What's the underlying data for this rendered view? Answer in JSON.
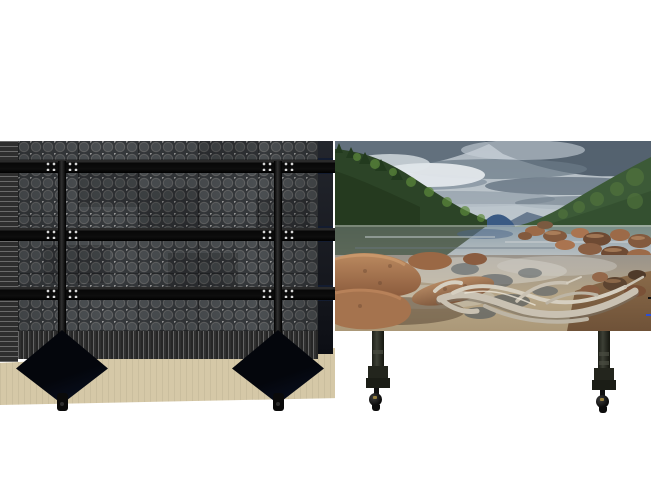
{
  "page": {
    "width": 670,
    "height": 497,
    "background": "#ffffff",
    "kind": "product-photo"
  },
  "product": {
    "name": "mobile-led-video-wall",
    "views": [
      {
        "id": "rear-view",
        "parts": [
          "perforated-back-panels",
          "frame-beam-top",
          "frame-beam-middle",
          "frame-beam-bottom",
          "stand-pole-left",
          "stand-pole-right",
          "stand-base-left",
          "stand-base-right",
          "caster-wheel-left",
          "caster-wheel-right",
          "floor-shadow"
        ]
      },
      {
        "id": "front-view",
        "parts": [
          "led-screen",
          "screen-leg-left",
          "screen-leg-right",
          "caster-wheel-left",
          "caster-wheel-right"
        ]
      }
    ]
  },
  "scene": {
    "name": "lake-landscape",
    "elements": [
      "cloudy-sky",
      "left-forest-shoreline",
      "twin-blue-mountains",
      "green-mountain-right",
      "far-ridge",
      "lake-water",
      "shore-rocks-right",
      "shallow-foreground-water",
      "submerged-stones",
      "boulders-bottom-left",
      "driftwood-root",
      "sand-bottom-right"
    ]
  },
  "colors": {
    "page-bg": "#ffffff",
    "floor-shadow": "#d5c8a7",
    "panel-base": "#36393c",
    "panel-circle": "#4b4f52",
    "panel-ring": "#6e6e6e",
    "panel-node": "#9b9b9b",
    "frame-black": "#0a0a0b",
    "edge-strip-accent": "#131c30",
    "leg": "#32342c",
    "caster-gold": "#97803f",
    "sky-light": "#ccd3d8",
    "sky-mid": "#8795a3",
    "sky-dark": "#4c5a68",
    "forest": "#2c4427",
    "foliage": "#5d8a3b",
    "mountain-blue": "#2e4e78",
    "mountain-green": "#3c5a37",
    "water": "#8ea0ac",
    "water-dark": "#45523f",
    "rock": "#a8714e",
    "rock-dark": "#6e4a33",
    "rock-light": "#c99a70",
    "driftwood": "#c9c1b2",
    "driftwood-dark": "#7a7264",
    "sand": "#8a6b4a"
  }
}
